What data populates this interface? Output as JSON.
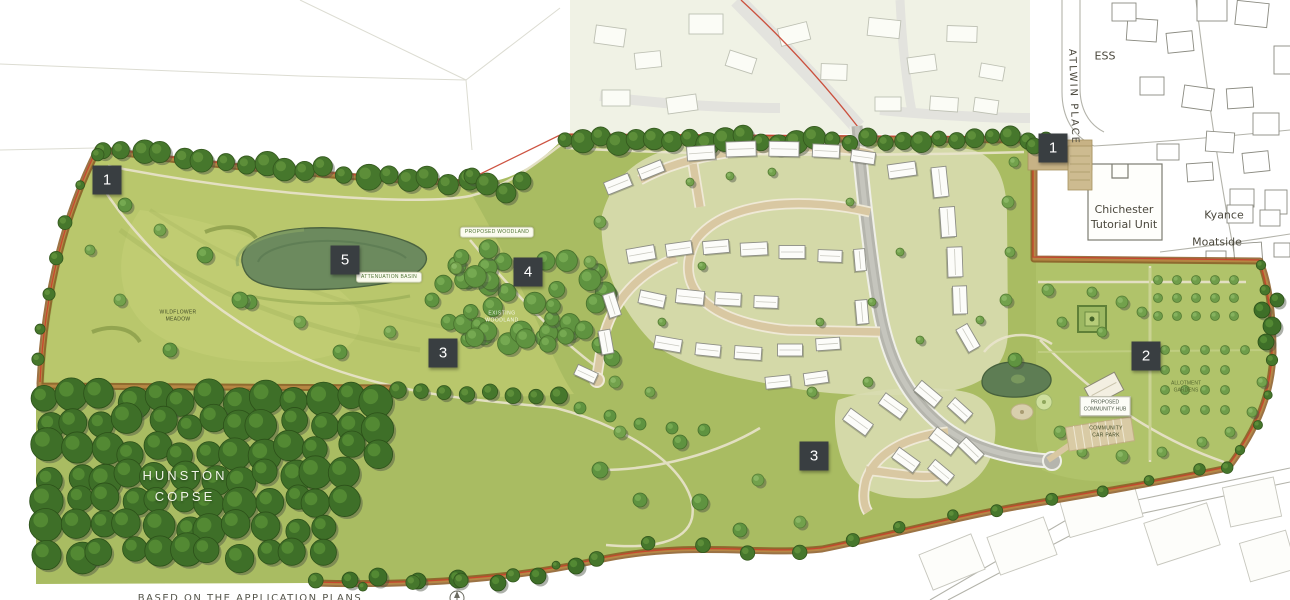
{
  "meta": {
    "type": "illustrative-masterplan-site-plan"
  },
  "markers": [
    {
      "id": "marker-1-west",
      "label": "1",
      "x": 107,
      "y": 180
    },
    {
      "id": "marker-1-northeast",
      "label": "1",
      "x": 1053,
      "y": 148
    },
    {
      "id": "marker-5-basin",
      "label": "5",
      "x": 345,
      "y": 260
    },
    {
      "id": "marker-4-woodland",
      "label": "4",
      "x": 528,
      "y": 272
    },
    {
      "id": "marker-3-west",
      "label": "3",
      "x": 443,
      "y": 353
    },
    {
      "id": "marker-2-allotments",
      "label": "2",
      "x": 1146,
      "y": 356
    },
    {
      "id": "marker-3-south",
      "label": "3",
      "x": 814,
      "y": 456
    }
  ],
  "labels": [
    {
      "id": "hunston-copse",
      "text": "HUNSTON\nCOPSE",
      "x": 185,
      "y": 487,
      "cls": "lbl-copse"
    },
    {
      "id": "ess",
      "text": "ESS",
      "x": 1105,
      "y": 57,
      "cls": "lbl-os"
    },
    {
      "id": "atlwin-place",
      "text": "ATLWIN PLACE",
      "x": 1073,
      "y": 97,
      "cls": "lbl-os lbl-vertical"
    },
    {
      "id": "chichester-tutorial-unit",
      "text": "Chichester\nTutorial Unit",
      "x": 1124,
      "y": 218,
      "cls": "lbl-os"
    },
    {
      "id": "kyance",
      "text": "Kyance",
      "x": 1224,
      "y": 216,
      "cls": "lbl-os"
    },
    {
      "id": "moatside",
      "text": "Moatside",
      "x": 1217,
      "y": 243,
      "cls": "lbl-os"
    },
    {
      "id": "pill-woodland",
      "text": "PROPOSED WOODLAND",
      "x": 497,
      "y": 232,
      "cls": "lbl-pill"
    },
    {
      "id": "pill-basin",
      "text": "ATTENUATION BASIN",
      "x": 389,
      "y": 277,
      "cls": "lbl-pill"
    },
    {
      "id": "meadow",
      "text": "WILDFLOWER\nMEADOW",
      "x": 178,
      "y": 316,
      "cls": "lbl-tiny-dark"
    },
    {
      "id": "woodland-faint",
      "text": "EXISTING\nWOODLAND",
      "x": 502,
      "y": 317,
      "cls": "lbl-tiny-white"
    },
    {
      "id": "community-hub",
      "text": "PROPOSED\nCOMMUNITY HUB",
      "x": 1105,
      "y": 406,
      "cls": "lbl-tiny-box"
    },
    {
      "id": "car-park",
      "text": "COMMUNITY\nCAR PARK",
      "x": 1106,
      "y": 432,
      "cls": "lbl-tiny-dark"
    },
    {
      "id": "allotments",
      "text": "ALLOTMENT\nGARDENS",
      "x": 1186,
      "y": 387,
      "cls": "lbl-tiny-green"
    },
    {
      "id": "caption",
      "text": "BASED ON THE APPLICATION PLANS",
      "x": 250,
      "y": 592,
      "cls": "lbl-caption"
    }
  ],
  "colors": {
    "site_green": "#a9bc62",
    "meadow_green": "#b9c76c",
    "copse_dark": "#3e6f28",
    "boundary_hedge": "#8a5a24",
    "application_boundary_red": "#c8402c",
    "primary_street_grey": "#b5b5ad",
    "secondary_street_beige": "#d9c8a2",
    "pond_green": "#6c8a5e",
    "marker_background": "#393e41",
    "marker_text": "#ffffff",
    "context_estate_background": "#ebeedb"
  }
}
